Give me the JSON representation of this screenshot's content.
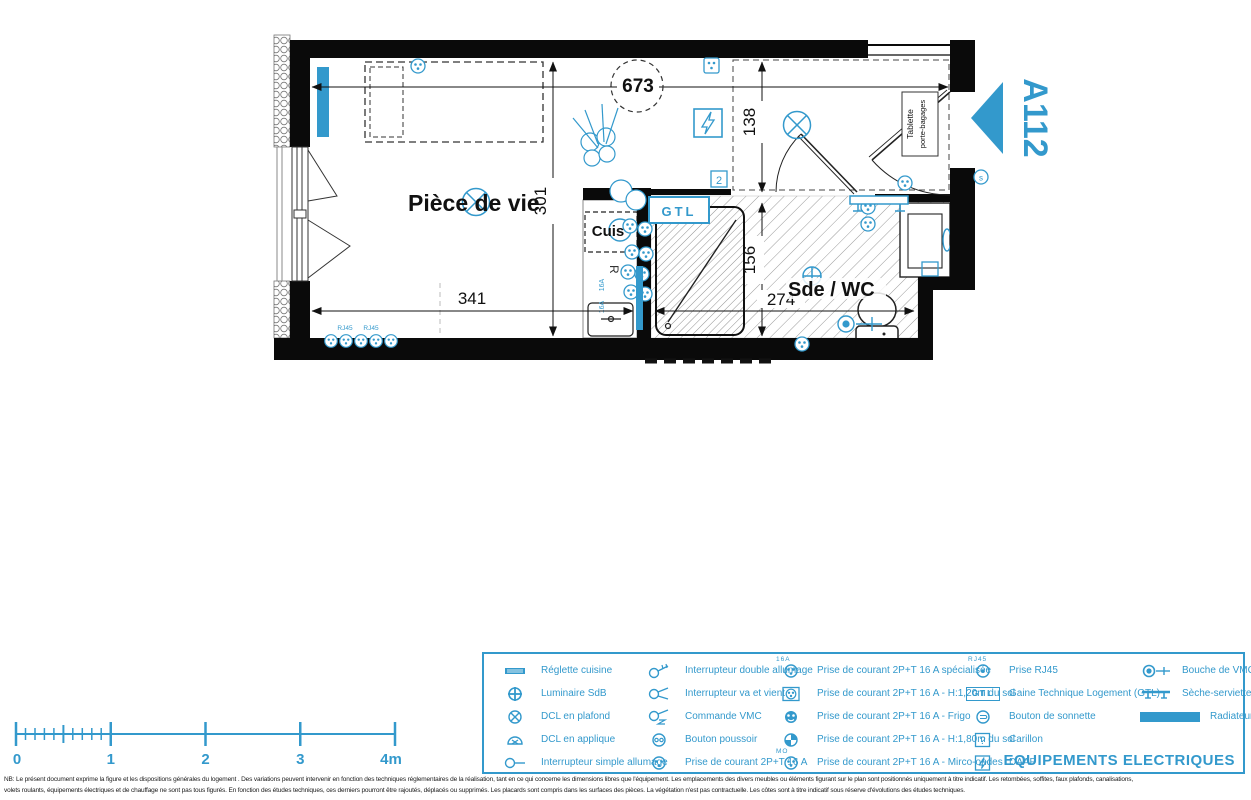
{
  "colors": {
    "accent": "#3399CC",
    "wall": "#0a0a0a",
    "hatch": "#9a9a9a"
  },
  "plan": {
    "unit": "A112",
    "living_room_label": "Pièce de vie",
    "bathroom_label": "Sde / WC",
    "kitchen_label": "Cuis",
    "fridge_label": "R",
    "gtl_label": "GTL",
    "tablette_line1": "Tablette",
    "tablette_line2": "porte-bagages",
    "rj45_label_1": "RJ45",
    "rj45_label_2": "RJ45",
    "outlet_tag_1": "16A",
    "outlet_tag_2": "16A",
    "carillon_tag": "2",
    "sonnette_tag": "s",
    "dims": {
      "top_width": "673",
      "living_height": "301",
      "living_width": "341",
      "entry_height": "138",
      "bath_height": "156",
      "bath_width": "274"
    }
  },
  "scale_bar": {
    "ticks": [
      "0",
      "1",
      "2",
      "3",
      "4m"
    ]
  },
  "legend": {
    "title": "EQUIPEMENTS ELECTRIQUES",
    "gtl_icon_text": "GTL",
    "carillon_glyph": "?",
    "tags": {
      "a16": "16A",
      "mo": "MO",
      "rj45": "RJ45"
    },
    "columns": [
      {
        "items": [
          {
            "icon": "reglette-cuisine-icon",
            "label": "Réglette cuisine"
          },
          {
            "icon": "luminaire-sdb-icon",
            "label": "Luminaire SdB"
          },
          {
            "icon": "dcl-plafond-icon",
            "label": "DCL en plafond"
          },
          {
            "icon": "dcl-applique-icon",
            "label": "DCL en applique"
          },
          {
            "icon": "interrupteur-simple-icon",
            "label": "Interrupteur simple allumage"
          }
        ]
      },
      {
        "items": [
          {
            "icon": "interrupteur-double-icon",
            "label": "Interrupteur double allumage"
          },
          {
            "icon": "interrupteur-va-et-vient-icon",
            "label": "Interrupteur va et vient"
          },
          {
            "icon": "commande-vmc-icon",
            "label": "Commande VMC"
          },
          {
            "icon": "bouton-poussoir-icon",
            "label": "Bouton poussoir"
          },
          {
            "icon": "prise-16a-icon",
            "label": "Prise de courant 2P+T 16 A"
          }
        ]
      },
      {
        "items": [
          {
            "icon": "prise-specialisee-icon",
            "label": "Prise de courant 2P+T 16 A spécialisée"
          },
          {
            "icon": "prise-h120-icon",
            "label": "Prise de courant 2P+T 16 A - H:1,20m du sol"
          },
          {
            "icon": "prise-frigo-icon",
            "label": "Prise de courant 2P+T 16 A - Frigo"
          },
          {
            "icon": "prise-h180-icon",
            "label": "Prise de courant 2P+T 16 A - H:1,80m du sol"
          },
          {
            "icon": "prise-micro-ondes-icon",
            "label": "Prise de courant 2P+T 16 A - Mirco-ondes"
          }
        ]
      },
      {
        "items": [
          {
            "icon": "prise-rj45-icon",
            "label": "Prise RJ45"
          },
          {
            "icon": "gtl-icon",
            "label": "Gaine Technique Logement (GTL)"
          },
          {
            "icon": "bouton-sonnette-icon",
            "label": "Bouton de sonnette"
          },
          {
            "icon": "carillon-icon",
            "label": "Carillon"
          },
          {
            "icon": "daaf-icon",
            "label": "DAAF"
          }
        ]
      },
      {
        "items": [
          {
            "icon": "bouche-vmc-icon",
            "label": "Bouche de VMC"
          },
          {
            "icon": "seche-serviette-icon",
            "label": "Sèche-serviette"
          },
          {
            "icon": "radiateur-icon",
            "label": "Radiateur"
          }
        ]
      }
    ]
  },
  "disclaimer": {
    "line1": "NB: Le présent document exprime la figure et les dispositions générales du logement . Des variations peuvent intervenir en fonction des techniques réglementaires de la réalisation, tant en ce qui concerne les dimensions libres que l'équipement. Les emplacements des divers meubles ou éléments figurant sur le plan sont positionnés uniquement à titre indicatif. Les retombées, soffites, faux plafonds, canalisations,",
    "line2": "volets roulants, équipements électriques et de chauffage ne sont pas tous figurés. En fonction des études techniques, ces derniers pourront être rajoutés, déplacés ou supprimés. Les placards sont compris dans les surfaces des pièces. La végétation n'est pas contractuelle. Les côtes sont à titre indicatif sous réserve d'évolutions des études techniques."
  }
}
